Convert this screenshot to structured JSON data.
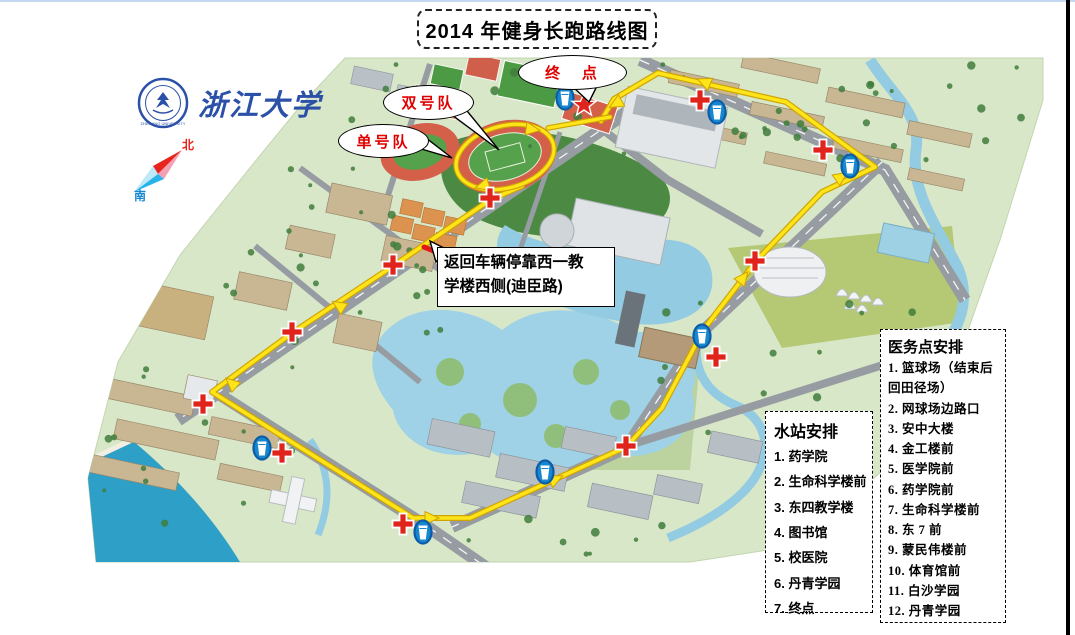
{
  "title": "2014 年健身长跑路线图",
  "logo": {
    "university_name": "浙江大学",
    "seal_text": "ZHEJIANG UNIVERSITY"
  },
  "compass": {
    "north_label": "北",
    "south_label": "南"
  },
  "callouts": {
    "finish": "终 点",
    "even_team": "双号队",
    "odd_team": "单号队",
    "return_note_line1": "返回车辆停靠西一教",
    "return_note_line2": "学楼西侧(迪臣路)"
  },
  "water_stations": {
    "title": "水站安排",
    "items": [
      "1. 药学院",
      "2. 生命科学楼前",
      "3. 东四教学楼",
      "4. 图书馆",
      "5. 校医院",
      "6. 丹青学园",
      "7. 终点"
    ]
  },
  "medical_points": {
    "title": "医务点安排",
    "items": [
      "1. 篮球场（结束后回田径场）",
      "2. 网球场边路口",
      "3. 安中大楼",
      "4. 金工楼前",
      "5. 医学院前",
      "6. 药学院前",
      "7. 生命科学楼前",
      "8. 东 7 前",
      "9. 蒙民伟楼前",
      "10. 体育馆前",
      "11. 白沙学园",
      "12. 丹青学园"
    ]
  },
  "map": {
    "route_color": "#ffe41a",
    "route_casing_color": "#cfa400",
    "medical_marker_color": "#e0241c",
    "water_marker_color": "#1788d0",
    "route_main": [
      [
        522,
        186
      ],
      [
        490,
        200
      ],
      [
        393,
        266
      ],
      [
        292,
        333
      ],
      [
        212,
        392
      ],
      [
        413,
        518
      ],
      [
        470,
        518
      ],
      [
        626,
        447
      ],
      [
        662,
        408
      ],
      [
        704,
        329
      ],
      [
        757,
        260
      ],
      [
        822,
        192
      ],
      [
        875,
        167
      ],
      [
        786,
        102
      ],
      [
        658,
        73
      ],
      [
        614,
        99
      ],
      [
        601,
        121
      ]
    ],
    "stadium_loop": {
      "cx": 505,
      "cy": 157,
      "rx": 50,
      "ry": 31,
      "rot": -15
    },
    "finish_connector": [
      [
        548,
        128
      ],
      [
        610,
        117
      ]
    ],
    "route_arrows": [
      [
        335,
        303,
        213
      ],
      [
        228,
        380,
        222
      ],
      [
        436,
        518,
        0
      ],
      [
        560,
        477,
        -25
      ],
      [
        746,
        274,
        -52
      ],
      [
        845,
        174,
        -35
      ],
      [
        700,
        80,
        203
      ],
      [
        612,
        106,
        150
      ],
      [
        478,
        187,
        165
      ],
      [
        537,
        130,
        8
      ]
    ],
    "medical_crosses": [
      [
        700,
        100
      ],
      [
        823,
        150
      ],
      [
        490,
        198
      ],
      [
        393,
        265
      ],
      [
        292,
        332
      ],
      [
        755,
        261
      ],
      [
        716,
        357
      ],
      [
        203,
        404
      ],
      [
        282,
        453
      ],
      [
        403,
        524
      ],
      [
        626,
        446
      ]
    ],
    "water_points": [
      [
        565,
        98
      ],
      [
        717,
        112
      ],
      [
        850,
        166
      ],
      [
        702,
        336
      ],
      [
        262,
        448
      ],
      [
        423,
        532
      ],
      [
        545,
        472
      ]
    ],
    "finish_star": [
      584,
      105
    ],
    "parking_line": [
      [
        424,
        247
      ],
      [
        480,
        270
      ]
    ]
  }
}
